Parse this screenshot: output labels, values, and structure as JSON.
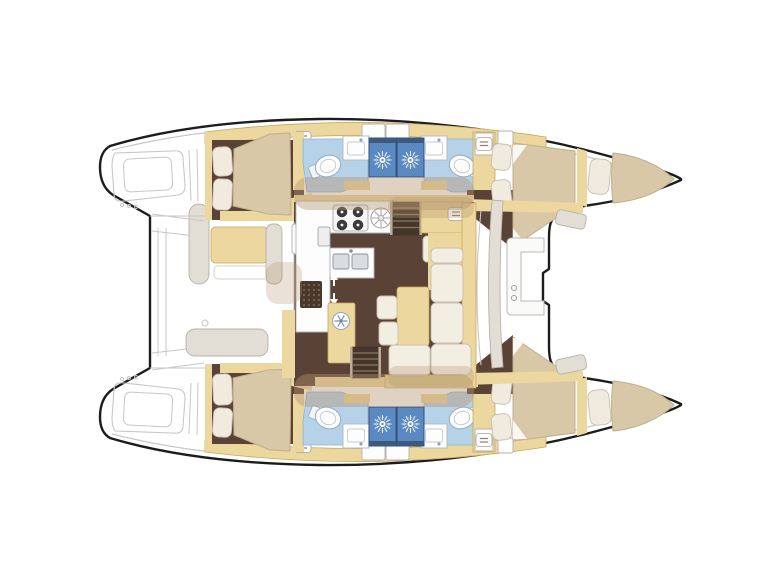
{
  "document": {
    "type": "boat-floor-plan",
    "title": "Catamaran accommodation and deck plan",
    "description": "Top-down layout plan of a 4-cabin sailing catamaran, bow to the right, stern with transom steps to the left",
    "orientation": {
      "bow": "right",
      "stern": "left"
    }
  },
  "palette": {
    "hull_outline": "#1c1c1c",
    "deck_line": "#c7c7c7",
    "wall_yellow": "#ecd89e",
    "wall_edge": "#c9a95c",
    "floor_brown": "#5a4336",
    "bed_tan": "#d9c8a7",
    "bed_edge": "#bfae8d",
    "pillow_cream": "#f1ebdf",
    "pillow_edge": "#c7bfae",
    "sofa_cream": "#f3eee2",
    "sofa_edge": "#c8c0b0",
    "bath_blue": "#b5d2e8",
    "bath_edge": "#8fb0cc",
    "shower_blue": "#5b8ac2",
    "shower_edge": "#30507a",
    "ext_gray": "#e2ded5",
    "ext_edge": "#b7b1a5",
    "counter_white": "#fdfdfd",
    "counter_edge": "#b2b2b2",
    "shadow_tan": "#b5946f",
    "steps_dark": "#46362a",
    "steps_tread": "#8a7763",
    "steps_rail": "#b9ad9d",
    "white": "#ffffff"
  },
  "areas": [
    {
      "id": "port-aft-cabin",
      "label": "Port aft double cabin"
    },
    {
      "id": "port-aft-bathroom",
      "label": "Port aft bathroom with toilet, sink and shower"
    },
    {
      "id": "port-fwd-bathroom",
      "label": "Port forward bathroom with toilet, sink and shower"
    },
    {
      "id": "port-fwd-cabin",
      "label": "Port forward double cabin"
    },
    {
      "id": "port-bow-berth",
      "label": "Port bow berth"
    },
    {
      "id": "stbd-aft-cabin",
      "label": "Starboard aft double cabin"
    },
    {
      "id": "stbd-aft-bathroom",
      "label": "Starboard aft bathroom with toilet, sink and shower"
    },
    {
      "id": "stbd-fwd-bathroom",
      "label": "Starboard forward bathroom with toilet, sink and shower"
    },
    {
      "id": "stbd-fwd-cabin",
      "label": "Starboard forward double cabin"
    },
    {
      "id": "stbd-bow-berth",
      "label": "Starboard bow berth"
    },
    {
      "id": "saloon",
      "label": "Saloon with galley, nav station, dining table and L-sofa"
    },
    {
      "id": "aft-cockpit",
      "label": "Aft cockpit with bench seats and table"
    },
    {
      "id": "fwd-cockpit",
      "label": "Forward cockpit bench"
    },
    {
      "id": "transoms",
      "label": "Transom swim steps"
    },
    {
      "id": "foredeck",
      "label": "Foredeck / trampoline area between bows"
    }
  ],
  "icons": [
    "shower-starburst-icon",
    "toilet-icon",
    "double-sink-icon",
    "round-sink-icon",
    "stove-burners-icon",
    "fridge-vent-icon",
    "companionway-arrows-icon",
    "locker-chip-icon",
    "nav-instrument-icon",
    "deck-hatch-icon"
  ]
}
